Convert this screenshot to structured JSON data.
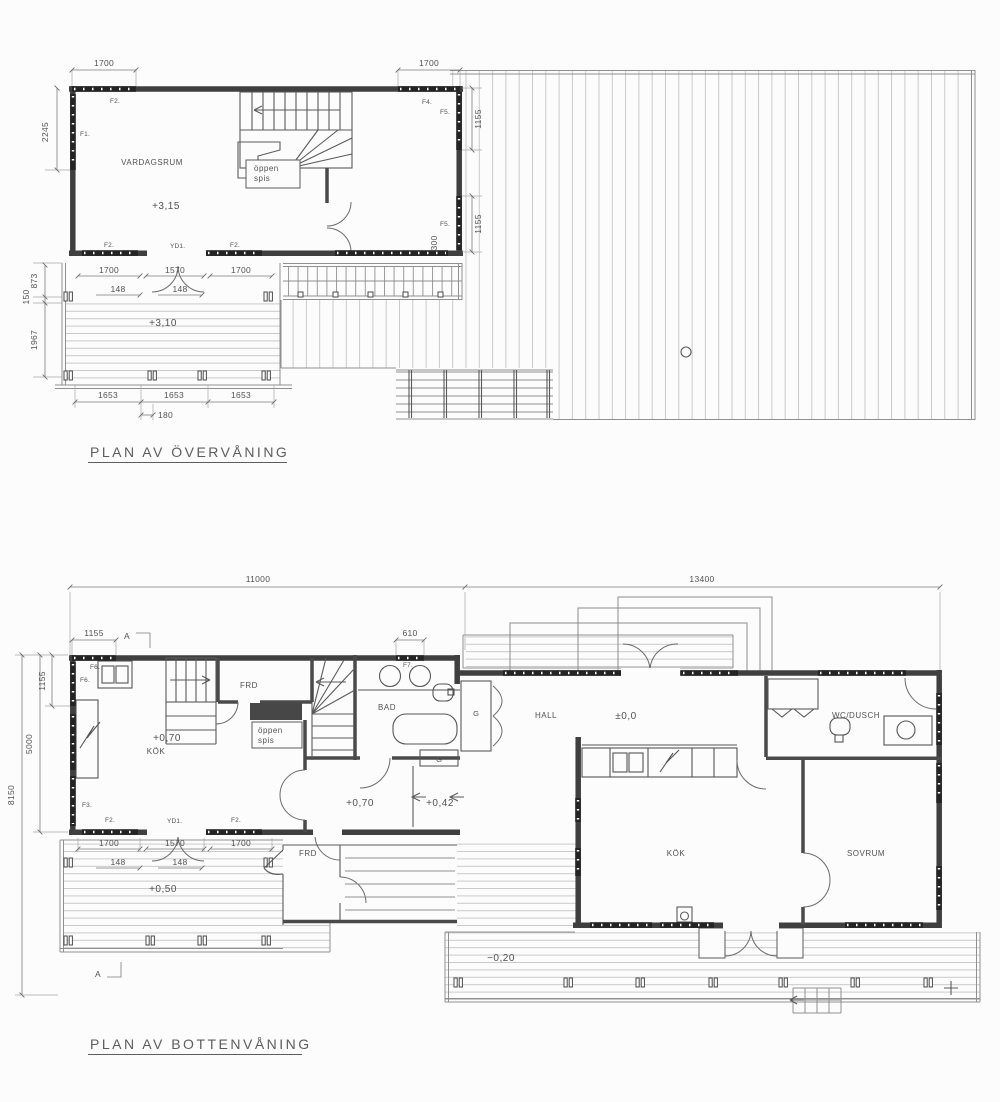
{
  "upper_plan": {
    "title": "PLAN AV ÖVERVÅNING",
    "room_labels": {
      "vardagsrum": "VARDAGSRUM",
      "oppen_spis_line1": "öppen",
      "oppen_spis_line2": "spis"
    },
    "level_labels": {
      "living": "+3,15",
      "deck": "+3,10"
    },
    "dimensions": {
      "d1700": "1700",
      "d1570": "1570",
      "d2245": "2245",
      "d1155": "1155",
      "d300": "300",
      "d873": "873",
      "d150": "150",
      "d1967": "1967",
      "d148": "148",
      "d1653": "1653",
      "d180": "180"
    },
    "opening_labels": {
      "f1": "F1.",
      "f2": "F2.",
      "f4": "F4.",
      "f5": "F5.",
      "yd1": "YD1."
    }
  },
  "lower_plan": {
    "title": "PLAN AV BOTTENVÅNING",
    "room_labels": {
      "kok": "KÖK",
      "frd": "FRD",
      "bad": "BAD",
      "hall": "HALL",
      "wc_dusch": "WC/DUSCH",
      "sovrum": "SOVRUM",
      "garderob": "G",
      "oppen_spis_line1": "öppen",
      "oppen_spis_line2": "spis"
    },
    "level_labels": {
      "kok": "+0,70",
      "hall": "±0,0",
      "step": "+0,42",
      "deck_south": "+0,50",
      "deck_east": "−0,20"
    },
    "dimensions": {
      "d11000": "11000",
      "d13400": "13400",
      "d1155": "1155",
      "d610": "610",
      "d5000": "5000",
      "d8150": "8150",
      "d1700": "1700",
      "d1570": "1570",
      "d148": "148"
    },
    "opening_labels": {
      "f2": "F2.",
      "f3": "F3.",
      "f6": "F6.",
      "f7": "F7.",
      "yd1": "YD1."
    },
    "section_marker": "A"
  }
}
